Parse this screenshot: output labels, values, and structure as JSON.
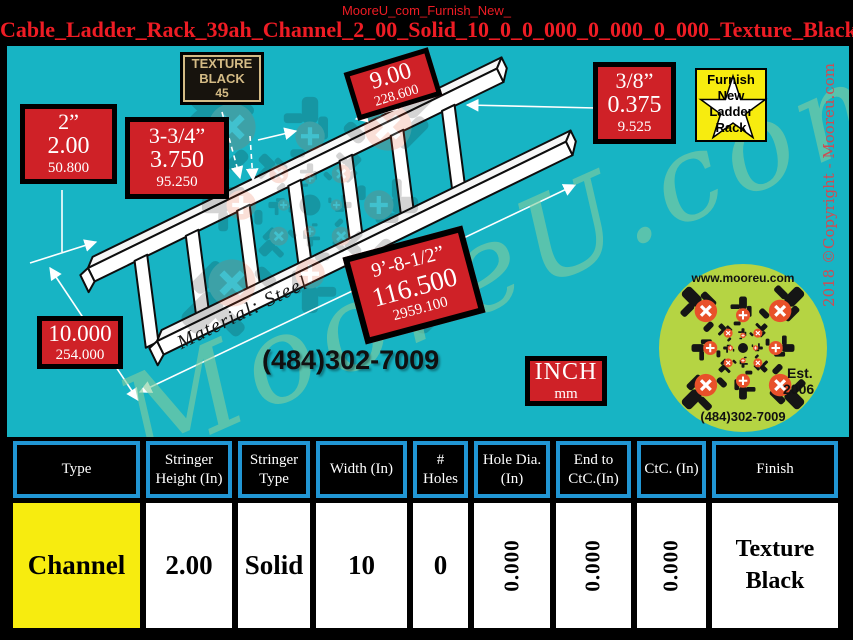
{
  "header": {
    "subtitle": "MooreU_com_Furnish_New_",
    "title": "Cable_Ladder_Rack_39ah_Channel_2_00_Solid_10_0_0_000_0_000_0_000_Texture_Black"
  },
  "diagram": {
    "material": "Material: Steel",
    "phone": "(484)302-7009",
    "watermark": "MooreU.com",
    "copyright": "2018 ©Copyright - Mooreu.com",
    "labels": {
      "stringer_height": {
        "l1": "2”",
        "l2": "2.00",
        "l3": "50.800"
      },
      "flange": {
        "l1": "3-3/4”",
        "l2": "3.750",
        "l3": "95.250"
      },
      "texture_plate": {
        "l1": "TEXTURE",
        "l2": "BLACK",
        "l3": "45"
      },
      "rung_spacing": {
        "l1": "9.00",
        "l2": "228.600"
      },
      "hole_diameter": {
        "l1": "3/8”",
        "l2": "0.375",
        "l3": "9.525"
      },
      "overall_length": {
        "l1": "9’-8-1/2”",
        "l2": "116.500",
        "l3": "2959.100"
      },
      "width": {
        "l1": "10.000",
        "l2": "254.000"
      },
      "units": {
        "l1": "INCH",
        "l2": "mm"
      }
    },
    "badge": {
      "l1": "Furnish",
      "l2": "New",
      "l3": "Ladder",
      "l4": "Rack"
    },
    "logo": {
      "url": "www.mooreu.com",
      "est": "Est.",
      "year": "2006",
      "phone": "(484)302-7009"
    }
  },
  "table": {
    "columns": [
      {
        "header": "Type",
        "value": "Channel"
      },
      {
        "header": "Stringer Height (In)",
        "value": "2.00"
      },
      {
        "header": "Stringer Type",
        "value": "Solid"
      },
      {
        "header": "Width (In)",
        "value": "10"
      },
      {
        "header": "# Holes",
        "value": "0"
      },
      {
        "header": "Hole Dia. (In)",
        "value": "0.000"
      },
      {
        "header": "End to CtC.(In)",
        "value": "0.000"
      },
      {
        "header": "CtC. (In)",
        "value": "0.000"
      },
      {
        "header": "Finish",
        "value": "Texture Black"
      }
    ]
  },
  "colors": {
    "background_teal": "#17b4c4",
    "label_red": "#cf2127",
    "title_red": "#ee1c24",
    "table_border_blue": "#2196d4",
    "highlight_yellow": "#f7ec0f",
    "logo_green": "#b5d443",
    "logo_orange": "#e8512a",
    "watermark_green": "#8ecfa4",
    "plate_tan": "#d4bb85"
  }
}
